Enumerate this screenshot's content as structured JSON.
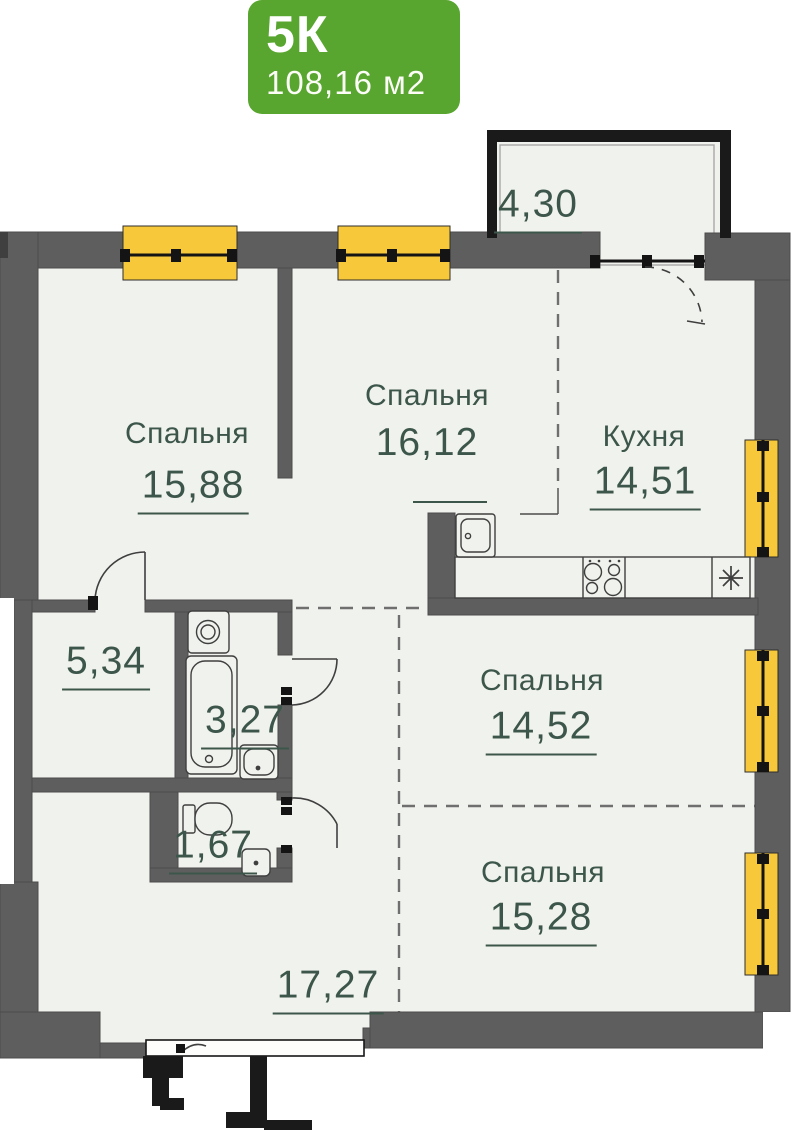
{
  "badge": {
    "type_label": "5К",
    "total_area": "108,16 м2"
  },
  "rooms": [
    {
      "id": "bedroom-1",
      "name": "Спальня",
      "area": "15,88"
    },
    {
      "id": "bedroom-2",
      "name": "Спальня",
      "area": "16,12"
    },
    {
      "id": "kitchen",
      "name": "Кухня",
      "area": "14,51"
    },
    {
      "id": "balcony",
      "name": "",
      "area": "4,30"
    },
    {
      "id": "storage",
      "name": "",
      "area": "5,34"
    },
    {
      "id": "bathroom",
      "name": "",
      "area": "3,27"
    },
    {
      "id": "wc",
      "name": "",
      "area": "1,67"
    },
    {
      "id": "bedroom-3",
      "name": "Спальня",
      "area": "14,52"
    },
    {
      "id": "bedroom-4",
      "name": "Спальня",
      "area": "15,28"
    },
    {
      "id": "hallway",
      "name": "",
      "area": "17,27"
    }
  ],
  "colors": {
    "badge_green": "#58a52f",
    "wall_gray": "#5e5e5e",
    "window_yellow": "#f8c83b",
    "floor": "#f0f2ed",
    "accent_text": "#3d564b",
    "outline_black": "#1a1a1a"
  }
}
